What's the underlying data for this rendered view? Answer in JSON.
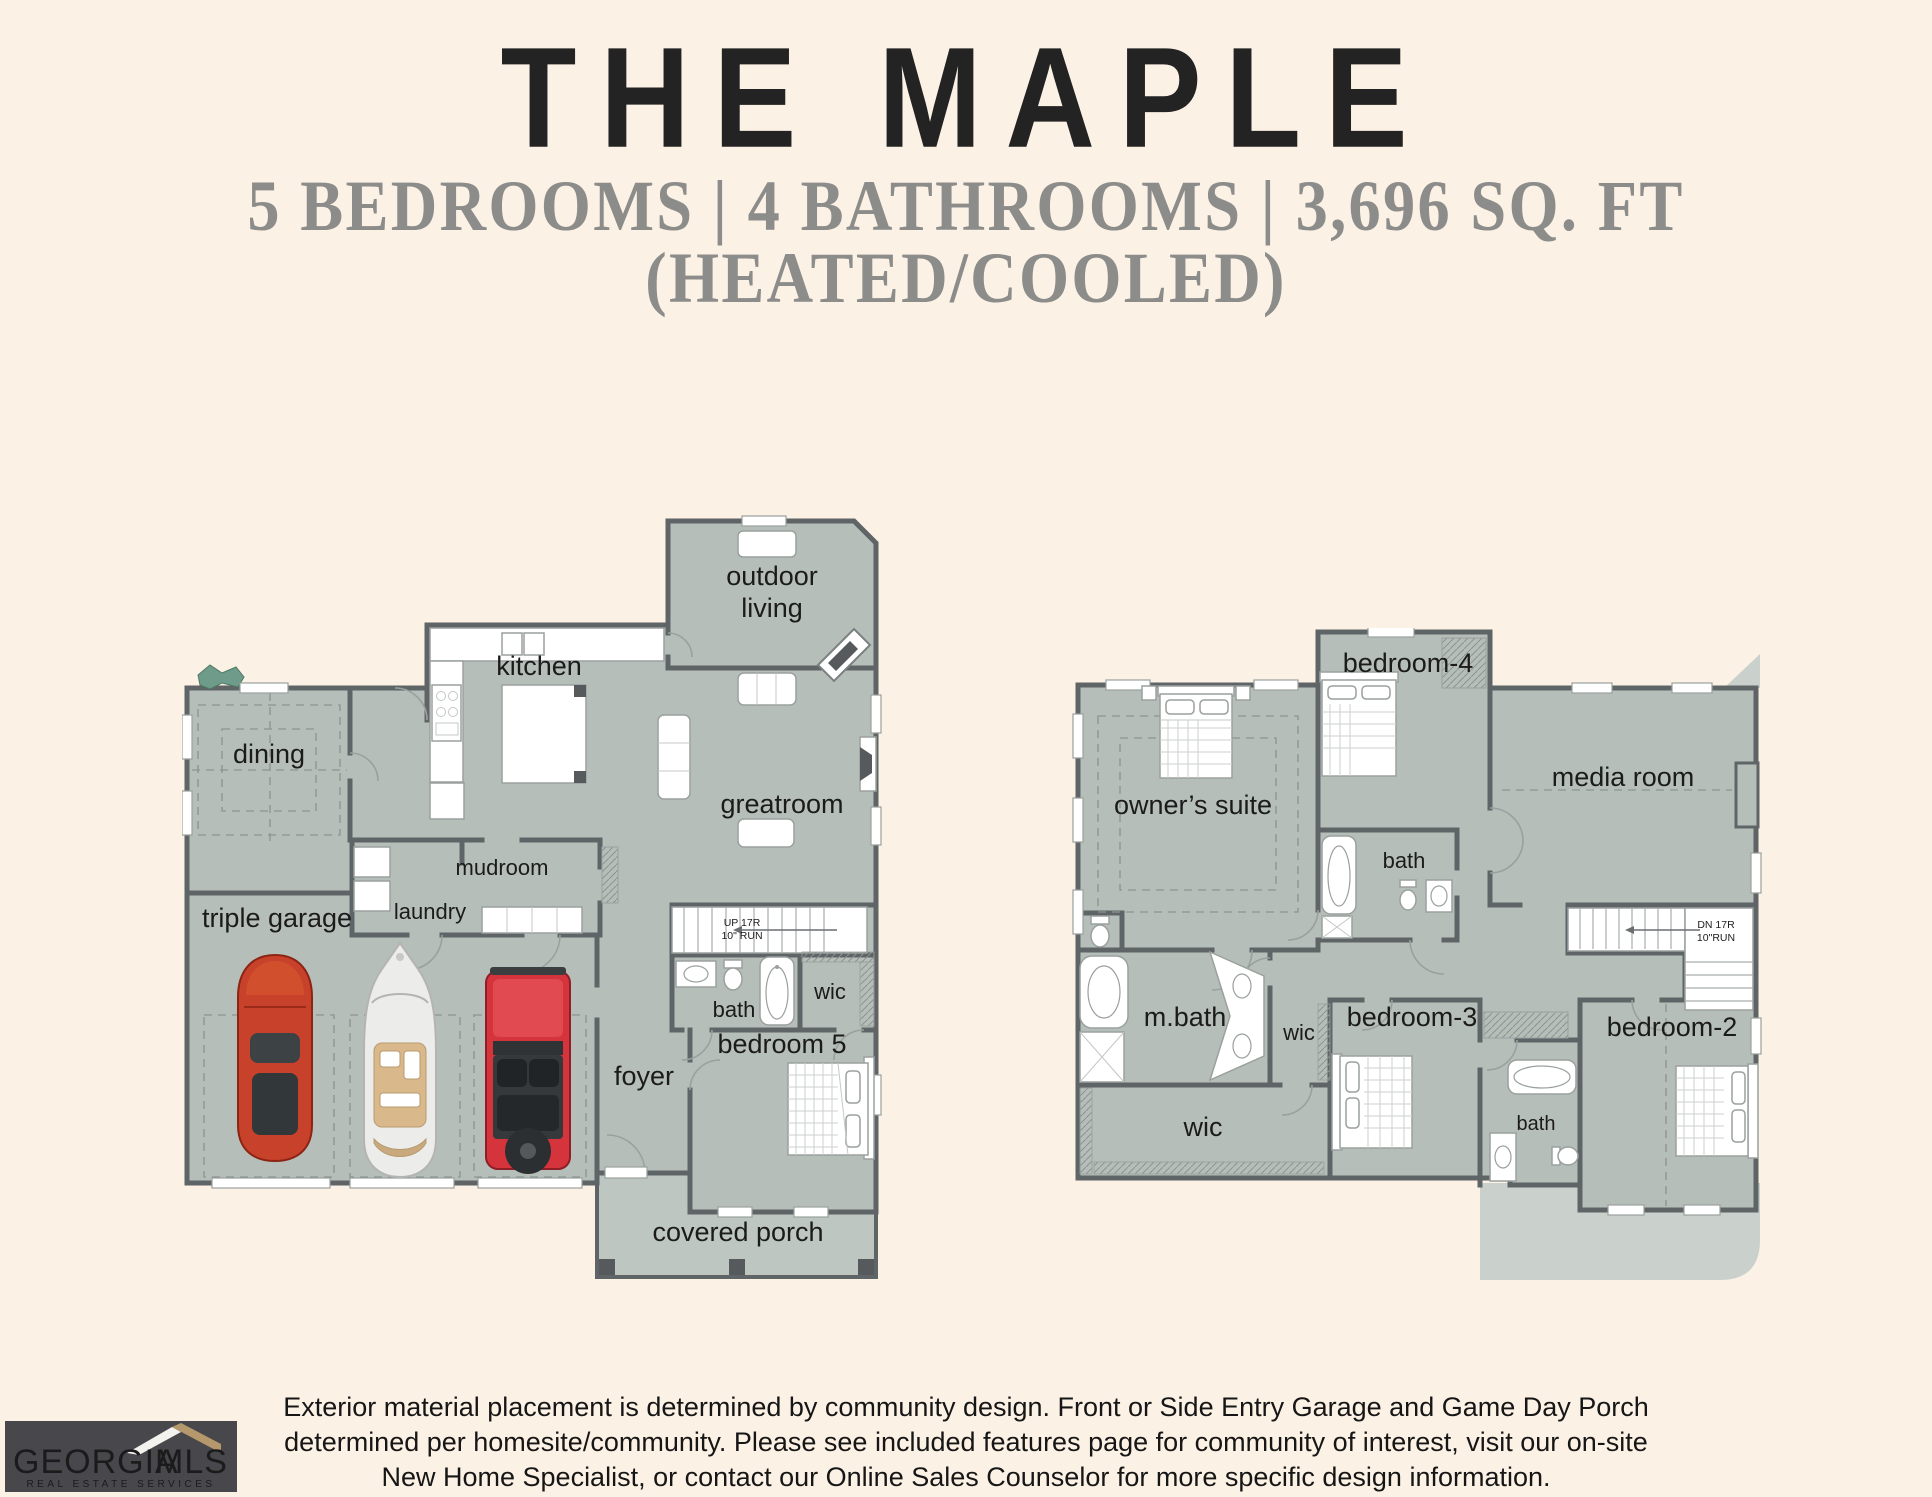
{
  "header": {
    "title": "THE MAPLE",
    "subtitle_line1": "5 BEDROOMS | 4 BATHROOMS | 3,696 SQ. FT",
    "subtitle_line2": "(HEATED/COOLED)"
  },
  "floor1": {
    "labels": {
      "outdoor_living_1": "outdoor",
      "outdoor_living_2": "living",
      "kitchen": "kitchen",
      "dining": "dining",
      "greatroom": "greatroom",
      "mudroom": "mudroom",
      "laundry": "laundry",
      "triple_garage": "triple garage",
      "stairs_1": "UP 17R",
      "stairs_2": "10\" RUN",
      "bath": "bath",
      "wic": "wic",
      "bedroom5": "bedroom 5",
      "foyer": "foyer",
      "covered_porch": "covered porch"
    }
  },
  "floor2": {
    "labels": {
      "owners_suite": "owner’s suite",
      "bedroom4": "bedroom-4",
      "media_room": "media room",
      "bath4": "bath",
      "mbath": "m.bath",
      "wic_small": "wic",
      "bedroom3": "bedroom-3",
      "bedroom2": "bedroom-2",
      "wic_large": "wic",
      "bath2": "bath",
      "stairs_1": "DN 17R",
      "stairs_2": "10\"RUN"
    }
  },
  "disclaimer": {
    "line1": "Exterior material placement is determined by community design. Front or Side Entry Garage and Game Day Porch",
    "line2": "determined per homesite/community. Please see included features page for community of interest, visit our on-site",
    "line3": "New Home Specialist, or contact our Online Sales Counselor for more specific design information."
  },
  "logo": {
    "name_part1": "GEORGIA",
    "name_part2": "MLS",
    "tagline": "REAL ESTATE SERVICES"
  },
  "icons": {
    "vehicles": [
      "sports-car-icon",
      "boat-icon",
      "jeep-icon"
    ],
    "furniture": [
      "bed-icon",
      "sofa-icon",
      "tub-icon",
      "toilet-icon",
      "sink-icon",
      "stairs-icon",
      "fireplace-icon",
      "plant-icon"
    ]
  },
  "colors": {
    "background": "#fcf1e5",
    "floor": "#b6beba",
    "walls": "#5f6466",
    "porch": "#bec6c1",
    "roof": "#cad1cc",
    "car_red": "#c8412a",
    "jeep_red": "#d6343c",
    "logo_bg": "#48474b",
    "logo_gold": "#b5986b",
    "title_text": "#232323",
    "subtitle_text": "#8c8c8a"
  }
}
